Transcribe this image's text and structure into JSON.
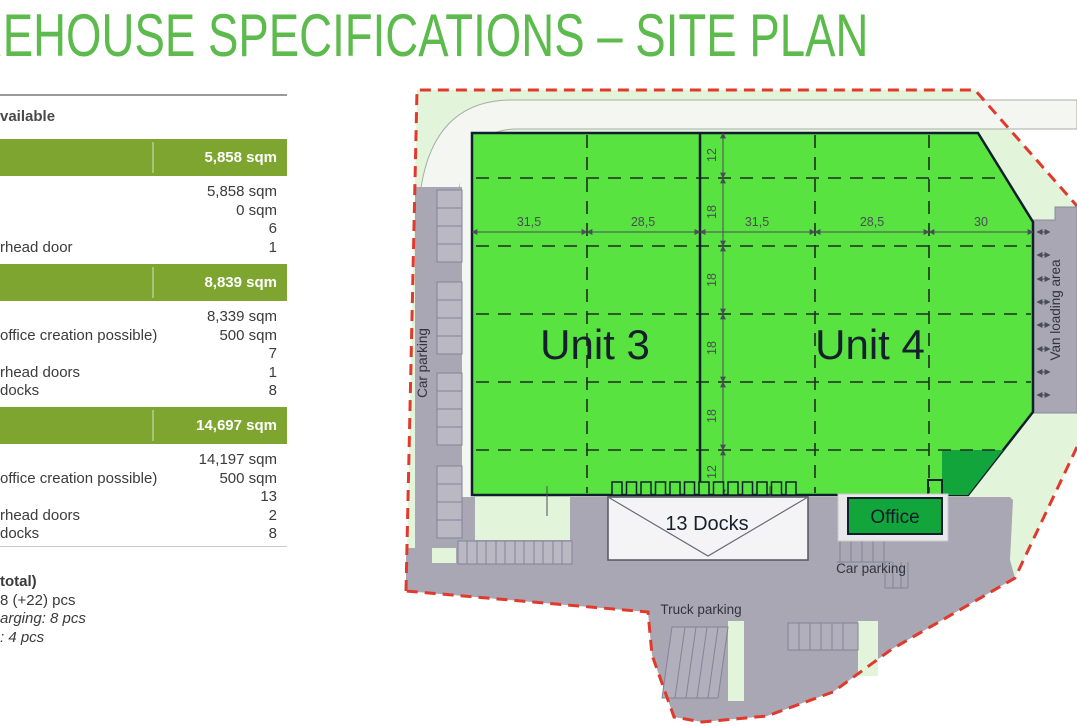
{
  "title": "WAREHOUSE SPECIFICATIONS – SITE PLAN",
  "left_panel": {
    "header_fragment": "vailable",
    "sections": [
      {
        "total": "5,858 sqm",
        "rows": [
          {
            "label": "",
            "value": "5,858 sqm"
          },
          {
            "label": "",
            "value": "0 sqm"
          },
          {
            "label": "",
            "value": "6"
          },
          {
            "label": "rhead door",
            "value": "1"
          }
        ]
      },
      {
        "total": "8,839 sqm",
        "rows": [
          {
            "label": "",
            "value": "8,339 sqm"
          },
          {
            "label": "office creation possible)",
            "value": "500 sqm"
          },
          {
            "label": "",
            "value": "7"
          },
          {
            "label": "rhead doors",
            "value": "1"
          },
          {
            "label": "docks",
            "value": "8"
          }
        ]
      },
      {
        "total": "14,697 sqm",
        "rows": [
          {
            "label": "",
            "value": "14,197 sqm"
          },
          {
            "label": "office creation possible)",
            "value": "500 sqm"
          },
          {
            "label": "",
            "value": "13"
          },
          {
            "label": "rhead doors",
            "value": "2"
          },
          {
            "label": "docks",
            "value": "8"
          }
        ]
      }
    ],
    "footer": {
      "line1": "total)",
      "line2": "8 (+22) pcs",
      "line3": "arging: 8 pcs",
      "line4": ": 4 pcs"
    }
  },
  "site_plan": {
    "unit3": "Unit 3",
    "unit4": "Unit 4",
    "docks": "13 Docks",
    "office": "Office",
    "car_parking_left": "Car parking",
    "car_parking_right": "Car parking",
    "truck_parking": "Truck parking",
    "van_loading": "Van loading area",
    "h_dims": [
      "31,5",
      "28,5",
      "31,5",
      "28,5",
      "30"
    ],
    "v_dims": [
      "12",
      "18",
      "18",
      "18",
      "18",
      "12"
    ]
  },
  "colors": {
    "title_green": "#5CBB4C",
    "table_bar_green": "#7DA52F",
    "building_green": "#58E340",
    "dark_green": "#12A53C",
    "site_light_green": "#E2F5DB",
    "pavement_gray": "#A8A7B3",
    "boundary_red": "#E2392D"
  }
}
